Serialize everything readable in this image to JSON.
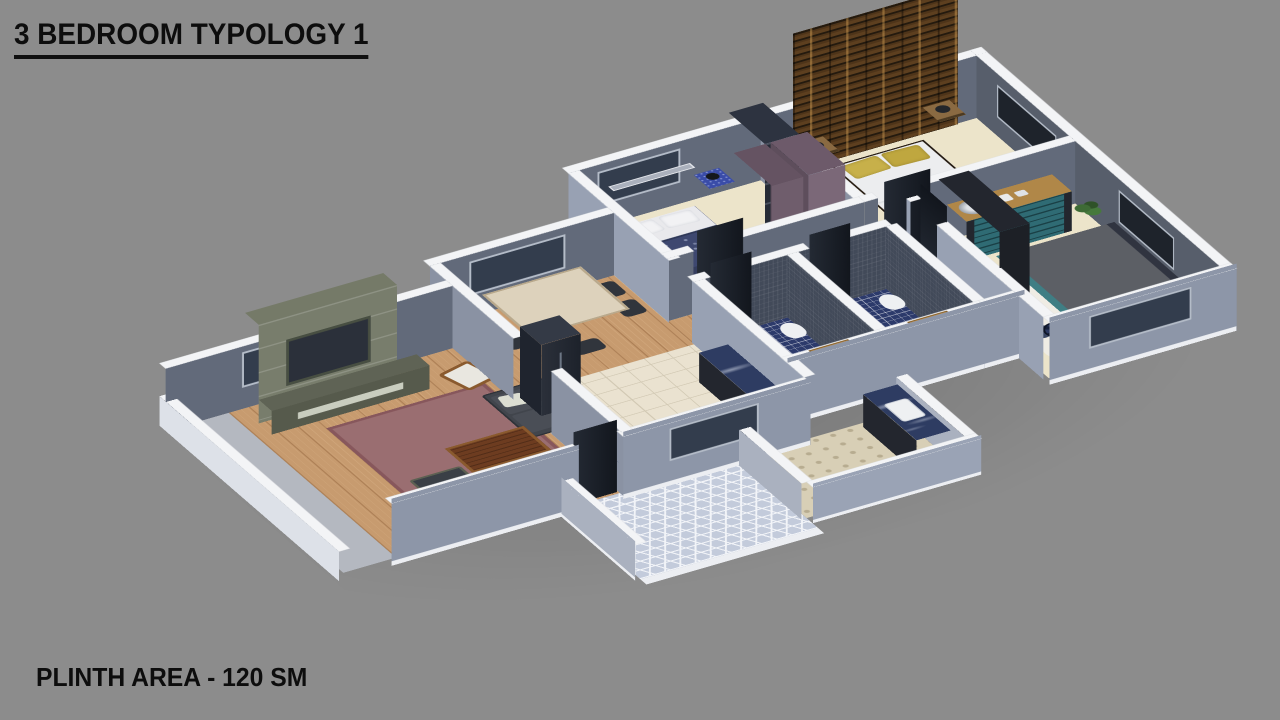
{
  "title": "3 BEDROOM TYPOLOGY 1",
  "footer": {
    "plinth_area_label": "PLINTH AREA - 120 SM"
  },
  "scene": {
    "type": "3d_isometric_floor_plan",
    "background_color": "#8c8c8c",
    "rooms": [
      {
        "name": "balcony",
        "floor": "gray",
        "features": [
          "white-railing"
        ]
      },
      {
        "name": "living-room",
        "floor": "wood-plank",
        "rug": "#9a6e71",
        "furniture": [
          "tv-wall-unit",
          "sofa",
          "loveseat",
          "ottoman",
          "accent-chair",
          "coffee-table",
          "side-tables"
        ]
      },
      {
        "name": "dining",
        "floor": "wood-plank",
        "furniture": [
          "dining-table",
          "six-chairs"
        ]
      },
      {
        "name": "kitchen",
        "floor": "cream-tile",
        "furniture": [
          "fridge",
          "l-shaped-counter",
          "sink",
          "cooktop"
        ]
      },
      {
        "name": "entrance-porch",
        "floor": "triangle-pattern-tile"
      },
      {
        "name": "utility-yard",
        "floor": "patterned-tile",
        "furniture": [
          "wash-counter",
          "sink"
        ]
      },
      {
        "name": "bedroom-2",
        "floor": "cream",
        "furniture": [
          "double-bed",
          "blue-floral-duvet",
          "nightstands",
          "lamps",
          "purple-wardrobes",
          "bookshelf"
        ]
      },
      {
        "name": "bathroom-1",
        "floor": "blue-mosaic",
        "furniture": [
          "shower-tray",
          "toilet"
        ]
      },
      {
        "name": "bathroom-2",
        "floor": "blue-mosaic",
        "furniture": [
          "shower-tray",
          "toilet"
        ]
      },
      {
        "name": "corridor",
        "floor": "wood-plank"
      },
      {
        "name": "master-bedroom",
        "floor": "cream",
        "furniture": [
          "double-bed",
          "mustard-pillows",
          "wood-slat-accent-wall",
          "nightstands",
          "lamps",
          "corner-chair"
        ]
      },
      {
        "name": "bedroom-3",
        "floor": "cream",
        "furniture": [
          "platform-bed",
          "cowhide-rug",
          "teal-sideboard",
          "table-lamp",
          "wardrobe",
          "plant",
          "round-side-tables"
        ]
      }
    ],
    "palette": {
      "walls_top": "#f3f4f6",
      "walls_light": "#98a1b3",
      "walls_dark": "#626a7a",
      "wood_floor": "#c79b6f",
      "cream_floor": "#ece4ca",
      "mosaic_floor": "#2c3a6b",
      "counter_marble": "#2e3c62",
      "rug_mauve": "#9a6e71",
      "duvet_blue": "#3e4870",
      "pillow_mustard": "#c7b04a",
      "slat_wall_brown": "#54381c",
      "wardrobe_purple": "#6d5a6a",
      "sideboard_teal": "#2f6b74"
    }
  }
}
